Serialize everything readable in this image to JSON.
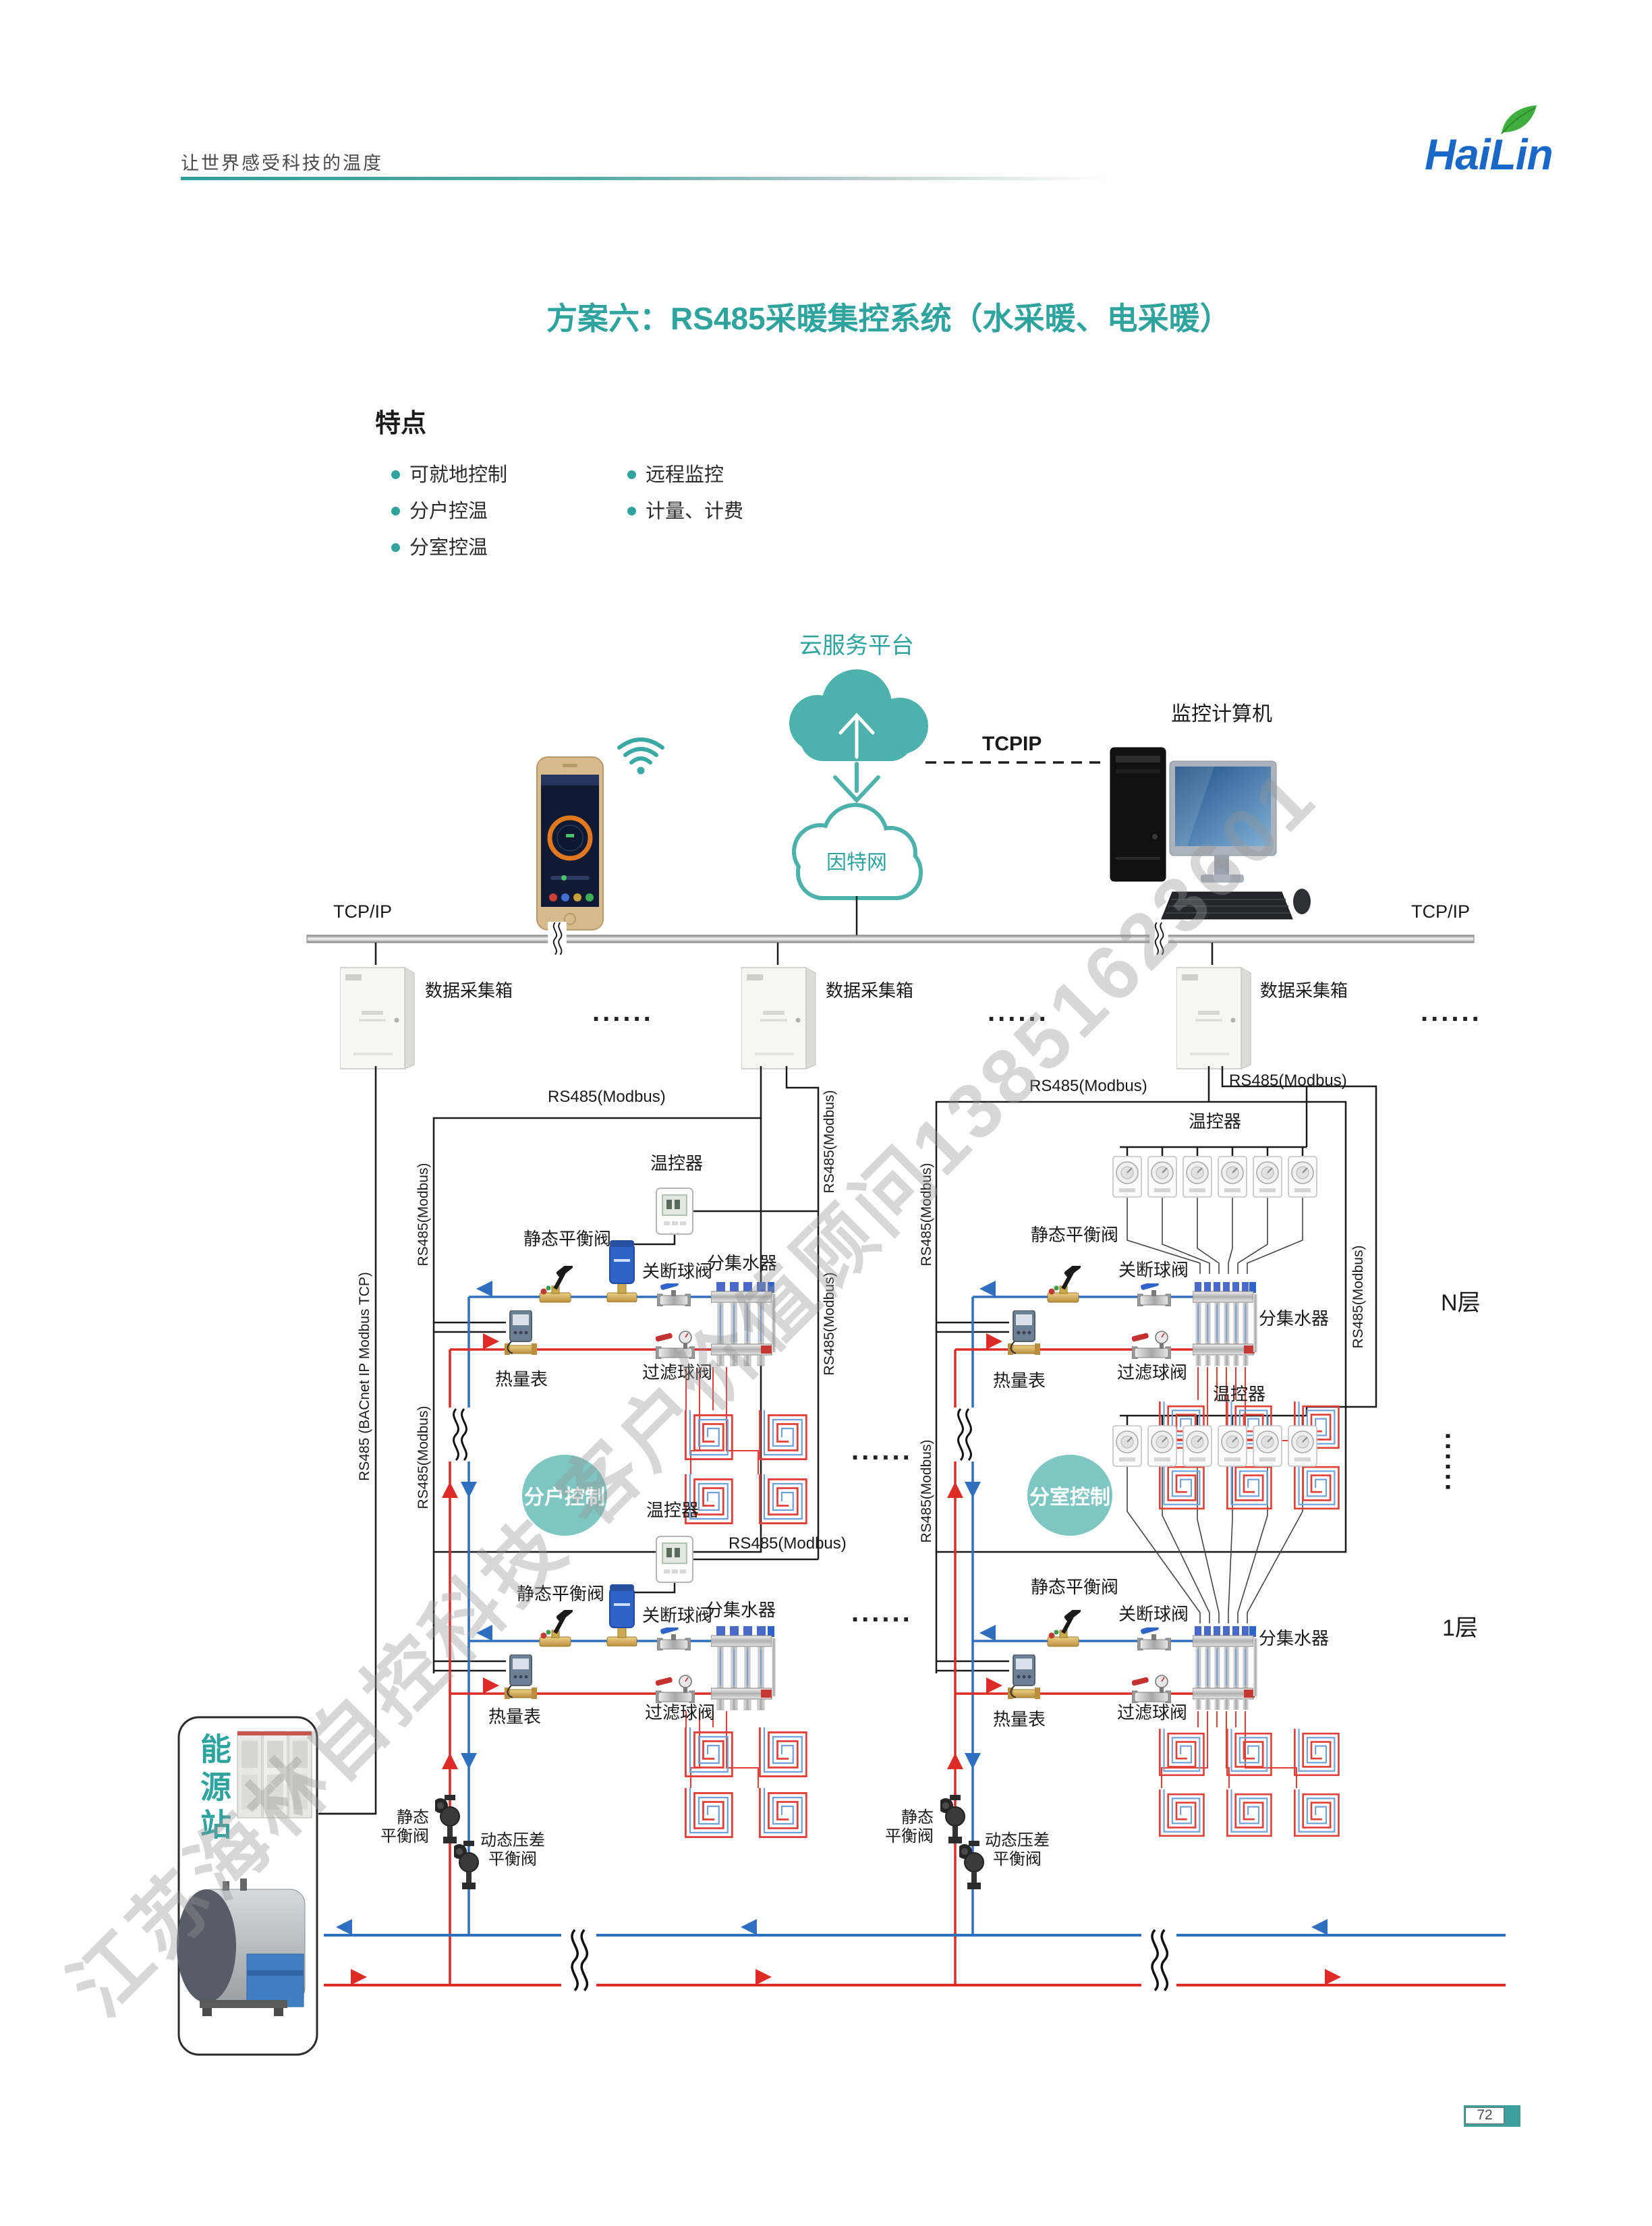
{
  "page": {
    "slogan": "让世界感受科技的温度",
    "logo": "HaiLin",
    "title": "方案六：RS485采暖集控系统（水采暖、电采暖）",
    "page_number": "72"
  },
  "features": {
    "heading": "特点",
    "column1": [
      "可就地控制",
      "分户控温",
      "分室控温"
    ],
    "column2": [
      "远程监控",
      "计量、计费"
    ]
  },
  "top": {
    "cloud_platform": "云服务平台",
    "tcpip_link": "TCPIP",
    "monitor_pc": "监控计算机",
    "internet": "因特网"
  },
  "bus": {
    "tcpip_left": "TCP/IP",
    "tcpip_right": "TCP/IP",
    "collector": "数据采集箱",
    "dots": "......"
  },
  "labels": {
    "rs485": "RS485(Modbus)",
    "bacnet": "RS485 (BACnet IP Modbus TCP)",
    "thermostat": "温控器",
    "static_valve": "静态平衡阀",
    "static_valve_l1": "静态",
    "static_valve_l2": "平衡阀",
    "dynamic_valve_l1": "动态压差",
    "dynamic_valve_l2": "平衡阀",
    "shutoff_valve": "关断球阀",
    "manifold": "分集水器",
    "heat_meter": "热量表",
    "filter_valve": "过滤球阀",
    "household_control": "分户控制",
    "room_control": "分室控制",
    "floor_n": "N层",
    "floor_1": "1层",
    "energy_station": "能源站"
  },
  "watermark": "江苏海林自控科技 客户价值顾问13851623601",
  "colors": {
    "teal": "#2FA39E",
    "blue": "#2E6FBF",
    "red": "#DD2B26"
  }
}
